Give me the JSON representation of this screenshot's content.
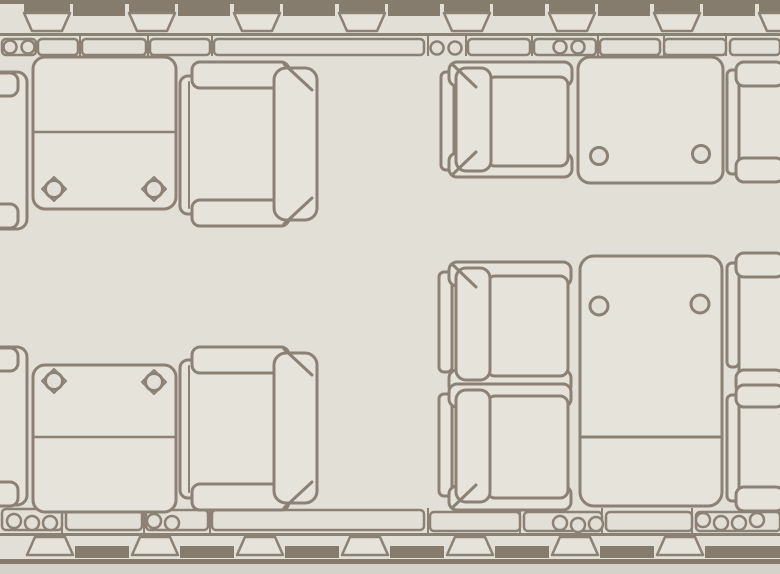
{
  "floor_plan": {
    "canvas": {
      "width": 780,
      "height": 574
    },
    "colors": {
      "floor": "#e2dfd7",
      "fill": "#e6e3db",
      "line": "#8b8174",
      "dark": "#857c6d",
      "outside": "#d5d2c9"
    },
    "walls": {
      "top": {
        "hull": {
          "y": 0,
          "h": 4
        },
        "bars": {
          "centers": [
            99,
            204,
            309,
            414,
            519,
            624,
            729
          ],
          "w": 52,
          "y": 4,
          "h": 12
        },
        "windows": {
          "centers": [
            47,
            152,
            257,
            362,
            467,
            572,
            677,
            782
          ],
          "capW": 46,
          "capY": 3,
          "capH": 11,
          "trapTopW": 46,
          "trapBotW": 30,
          "trapY1": 13,
          "trapY2": 31
        },
        "wallLine": {
          "y": 33,
          "h": 3
        },
        "ledge": [
          [
            2,
            39,
            34,
            16
          ],
          [
            38,
            39,
            40,
            16
          ],
          [
            82,
            39,
            64,
            16
          ],
          [
            150,
            39,
            60,
            16
          ],
          [
            214,
            39,
            210,
            16
          ],
          [
            468,
            39,
            62,
            16
          ],
          [
            534,
            39,
            62,
            16
          ],
          [
            600,
            39,
            60,
            16
          ],
          [
            664,
            39,
            62,
            16
          ],
          [
            730,
            39,
            50,
            16
          ]
        ],
        "ticks": {
          "y1": 36,
          "y2": 56,
          "xs": [
            80,
            148,
            212,
            428,
            466,
            532,
            598,
            664,
            726
          ]
        },
        "cups": [
          [
            10,
            47
          ],
          [
            28,
            47
          ],
          [
            437,
            48
          ],
          [
            455,
            48
          ],
          [
            560,
            47
          ],
          [
            578,
            47
          ]
        ]
      },
      "bottom": {
        "ledge": [
          [
            2,
            509,
            60,
            21
          ],
          [
            66,
            510,
            76,
            20
          ],
          [
            146,
            510,
            62,
            20
          ],
          [
            212,
            510,
            212,
            20
          ],
          [
            430,
            512,
            90,
            19
          ],
          [
            524,
            512,
            78,
            19
          ],
          [
            606,
            512,
            86,
            19
          ],
          [
            696,
            512,
            84,
            19
          ]
        ],
        "ticks": {
          "y1": 508,
          "y2": 535,
          "xs": [
            62,
            144,
            210,
            428,
            520,
            602,
            692
          ]
        },
        "cups": [
          [
            14,
            521
          ],
          [
            32,
            523
          ],
          [
            50,
            523
          ],
          [
            154,
            521
          ],
          [
            172,
            523
          ],
          [
            560,
            523
          ],
          [
            578,
            525
          ],
          [
            596,
            524
          ],
          [
            703,
            520
          ],
          [
            721,
            523
          ],
          [
            739,
            523
          ],
          [
            757,
            520
          ]
        ],
        "wallLine": {
          "y": 533,
          "h": 3
        },
        "bars": {
          "centers": [
            102,
            207,
            312,
            417,
            522,
            627,
            732,
            780
          ],
          "w": 54,
          "y": 546,
          "h": 12
        },
        "windows": {
          "centers": [
            50,
            155,
            260,
            365,
            470,
            575,
            680
          ],
          "trapTopW": 30,
          "trapBotW": 46,
          "trapY1": 537,
          "trapY2": 555
        },
        "hull": {
          "y": 559,
          "h": 5
        },
        "outside": {
          "y": 564,
          "h": 10
        }
      }
    },
    "furniture": [
      {
        "name": "seat-left-edge-top",
        "parts": [
          {
            "t": "rect",
            "x": -40,
            "y": 72,
            "w": 67,
            "h": 157,
            "r": 10
          },
          {
            "t": "rect",
            "x": -40,
            "y": 73,
            "w": 58,
            "h": 23,
            "r": 8
          },
          {
            "t": "rect",
            "x": -40,
            "y": 204,
            "w": 58,
            "h": 24,
            "r": 8
          }
        ]
      },
      {
        "name": "table-top-left",
        "parts": [
          {
            "t": "rect",
            "x": 33,
            "y": 57,
            "w": 143,
            "h": 152,
            "r": 12
          },
          {
            "t": "line",
            "x1": 35,
            "y1": 132,
            "x2": 174,
            "y2": 132,
            "sw": 2.5
          },
          {
            "t": "poly",
            "pts": [
              [
                54,
                177
              ],
              [
                66,
                189
              ],
              [
                54,
                201
              ],
              [
                42,
                189
              ]
            ],
            "sw": 2
          },
          {
            "t": "poly",
            "pts": [
              [
                154,
                177
              ],
              [
                166,
                189
              ],
              [
                154,
                201
              ],
              [
                142,
                189
              ]
            ],
            "sw": 2
          },
          {
            "t": "circle",
            "cx": 54,
            "cy": 189,
            "r": 8.5
          },
          {
            "t": "circle",
            "cx": 154,
            "cy": 189,
            "r": 8.5
          }
        ]
      },
      {
        "name": "seat-top-left-facing-left",
        "parts": [
          {
            "t": "rect",
            "x": 180,
            "y": 76,
            "w": 104,
            "h": 138,
            "r": 8
          },
          {
            "t": "rect",
            "x": 192,
            "y": 62,
            "w": 97,
            "h": 26,
            "r": 8
          },
          {
            "t": "rect",
            "x": 192,
            "y": 200,
            "w": 97,
            "h": 26,
            "r": 8
          },
          {
            "t": "rect",
            "x": 274,
            "y": 68,
            "w": 43,
            "h": 152,
            "r": 12
          },
          {
            "t": "line",
            "x1": 284,
            "y1": 64,
            "x2": 312,
            "y2": 90,
            "sw": 3
          },
          {
            "t": "line",
            "x1": 284,
            "y1": 224,
            "x2": 312,
            "y2": 198,
            "sw": 3
          },
          {
            "t": "line",
            "x1": 189,
            "y1": 82,
            "x2": 189,
            "y2": 208,
            "sw": 2
          }
        ]
      },
      {
        "name": "seat-top-right-facing-right",
        "parts": [
          {
            "t": "rect",
            "x": 441,
            "y": 72,
            "w": 13,
            "h": 98,
            "r": 5
          },
          {
            "t": "rect",
            "x": 449,
            "y": 62,
            "w": 123,
            "h": 24,
            "r": 8
          },
          {
            "t": "rect",
            "x": 449,
            "y": 153,
            "w": 123,
            "h": 24,
            "r": 8
          },
          {
            "t": "rect",
            "x": 487,
            "y": 77,
            "w": 81,
            "h": 89,
            "r": 8
          },
          {
            "t": "rect",
            "x": 456,
            "y": 68,
            "w": 35,
            "h": 103,
            "r": 10
          },
          {
            "t": "line",
            "x1": 452,
            "y1": 64,
            "x2": 476,
            "y2": 87,
            "sw": 3
          },
          {
            "t": "line",
            "x1": 452,
            "y1": 175,
            "x2": 476,
            "y2": 152,
            "sw": 3
          }
        ]
      },
      {
        "name": "table-top-right",
        "parts": [
          {
            "t": "rect",
            "x": 578,
            "y": 57,
            "w": 145,
            "h": 126,
            "r": 12
          },
          {
            "t": "circle",
            "cx": 599,
            "cy": 156,
            "r": 8.5
          },
          {
            "t": "circle",
            "cx": 701,
            "cy": 154,
            "r": 8.5
          }
        ]
      },
      {
        "name": "seat-right-edge-top",
        "parts": [
          {
            "t": "rect",
            "x": 727,
            "y": 70,
            "w": 12,
            "h": 104,
            "r": 5
          },
          {
            "t": "rect",
            "x": 739,
            "y": 73,
            "w": 45,
            "h": 98,
            "r": 6
          },
          {
            "t": "rect",
            "x": 736,
            "y": 62,
            "w": 48,
            "h": 24,
            "r": 8
          },
          {
            "t": "rect",
            "x": 736,
            "y": 158,
            "w": 48,
            "h": 24,
            "r": 8
          }
        ]
      },
      {
        "name": "seat-conference-left-upper",
        "parts": [
          {
            "t": "rect",
            "x": 439,
            "y": 272,
            "w": 13,
            "h": 100,
            "r": 5
          },
          {
            "t": "rect",
            "x": 449,
            "y": 262,
            "w": 122,
            "h": 24,
            "r": 8
          },
          {
            "t": "rect",
            "x": 449,
            "y": 370,
            "w": 122,
            "h": 24,
            "r": 8
          },
          {
            "t": "rect",
            "x": 487,
            "y": 276,
            "w": 81,
            "h": 100,
            "r": 8
          },
          {
            "t": "rect",
            "x": 456,
            "y": 268,
            "w": 34,
            "h": 112,
            "r": 10
          },
          {
            "t": "line",
            "x1": 452,
            "y1": 264,
            "x2": 476,
            "y2": 287,
            "sw": 3
          }
        ]
      },
      {
        "name": "seat-conference-left-lower",
        "parts": [
          {
            "t": "rect",
            "x": 439,
            "y": 394,
            "w": 13,
            "h": 102,
            "r": 5
          },
          {
            "t": "rect",
            "x": 449,
            "y": 384,
            "w": 122,
            "h": 23,
            "r": 8
          },
          {
            "t": "rect",
            "x": 449,
            "y": 486,
            "w": 122,
            "h": 24,
            "r": 8
          },
          {
            "t": "rect",
            "x": 487,
            "y": 396,
            "w": 81,
            "h": 102,
            "r": 8
          },
          {
            "t": "rect",
            "x": 456,
            "y": 390,
            "w": 34,
            "h": 112,
            "r": 10
          },
          {
            "t": "line",
            "x1": 452,
            "y1": 508,
            "x2": 476,
            "y2": 485,
            "sw": 3
          }
        ]
      },
      {
        "name": "table-conference",
        "parts": [
          {
            "t": "rect",
            "x": 580,
            "y": 256,
            "w": 142,
            "h": 250,
            "r": 14
          },
          {
            "t": "circle",
            "cx": 599,
            "cy": 306,
            "r": 9
          },
          {
            "t": "circle",
            "cx": 700,
            "cy": 304,
            "r": 9
          },
          {
            "t": "line",
            "x1": 582,
            "y1": 437,
            "x2": 720,
            "y2": 437,
            "sw": 3
          }
        ]
      },
      {
        "name": "seat-right-edge-upper",
        "parts": [
          {
            "t": "rect",
            "x": 727,
            "y": 263,
            "w": 12,
            "h": 104,
            "r": 5
          },
          {
            "t": "rect",
            "x": 739,
            "y": 266,
            "w": 45,
            "h": 110,
            "r": 6
          },
          {
            "t": "rect",
            "x": 736,
            "y": 253,
            "w": 48,
            "h": 24,
            "r": 8
          },
          {
            "t": "rect",
            "x": 736,
            "y": 370,
            "w": 48,
            "h": 24,
            "r": 8
          }
        ]
      },
      {
        "name": "seat-right-edge-lower",
        "parts": [
          {
            "t": "rect",
            "x": 727,
            "y": 395,
            "w": 12,
            "h": 106,
            "r": 5
          },
          {
            "t": "rect",
            "x": 739,
            "y": 398,
            "w": 45,
            "h": 104,
            "r": 6
          },
          {
            "t": "rect",
            "x": 736,
            "y": 385,
            "w": 48,
            "h": 22,
            "r": 8
          },
          {
            "t": "rect",
            "x": 736,
            "y": 487,
            "w": 48,
            "h": 24,
            "r": 8
          }
        ]
      },
      {
        "name": "seat-left-edge-bottom",
        "parts": [
          {
            "t": "rect",
            "x": -40,
            "y": 347,
            "w": 67,
            "h": 158,
            "r": 10
          },
          {
            "t": "rect",
            "x": -40,
            "y": 348,
            "w": 58,
            "h": 23,
            "r": 8
          },
          {
            "t": "rect",
            "x": -40,
            "y": 482,
            "w": 58,
            "h": 24,
            "r": 8
          }
        ]
      },
      {
        "name": "table-bottom-left",
        "parts": [
          {
            "t": "rect",
            "x": 33,
            "y": 365,
            "w": 143,
            "h": 147,
            "r": 12
          },
          {
            "t": "line",
            "x1": 35,
            "y1": 437,
            "x2": 174,
            "y2": 437,
            "sw": 2.5
          },
          {
            "t": "poly",
            "pts": [
              [
                54,
                369
              ],
              [
                66,
                381
              ],
              [
                54,
                393
              ],
              [
                42,
                381
              ]
            ],
            "sw": 2
          },
          {
            "t": "poly",
            "pts": [
              [
                154,
                370
              ],
              [
                166,
                382
              ],
              [
                154,
                394
              ],
              [
                142,
                382
              ]
            ],
            "sw": 2
          },
          {
            "t": "circle",
            "cx": 54,
            "cy": 381,
            "r": 8.5
          },
          {
            "t": "circle",
            "cx": 154,
            "cy": 382,
            "r": 8.5
          }
        ]
      },
      {
        "name": "seat-bottom-left-facing-left",
        "parts": [
          {
            "t": "rect",
            "x": 180,
            "y": 360,
            "w": 104,
            "h": 138,
            "r": 8
          },
          {
            "t": "rect",
            "x": 192,
            "y": 347,
            "w": 97,
            "h": 26,
            "r": 8
          },
          {
            "t": "rect",
            "x": 192,
            "y": 484,
            "w": 97,
            "h": 26,
            "r": 8
          },
          {
            "t": "rect",
            "x": 274,
            "y": 353,
            "w": 43,
            "h": 150,
            "r": 12
          },
          {
            "t": "line",
            "x1": 284,
            "y1": 349,
            "x2": 312,
            "y2": 375,
            "sw": 3
          },
          {
            "t": "line",
            "x1": 284,
            "y1": 508,
            "x2": 312,
            "y2": 482,
            "sw": 3
          },
          {
            "t": "line",
            "x1": 189,
            "y1": 366,
            "x2": 189,
            "y2": 492,
            "sw": 2
          }
        ]
      }
    ]
  }
}
